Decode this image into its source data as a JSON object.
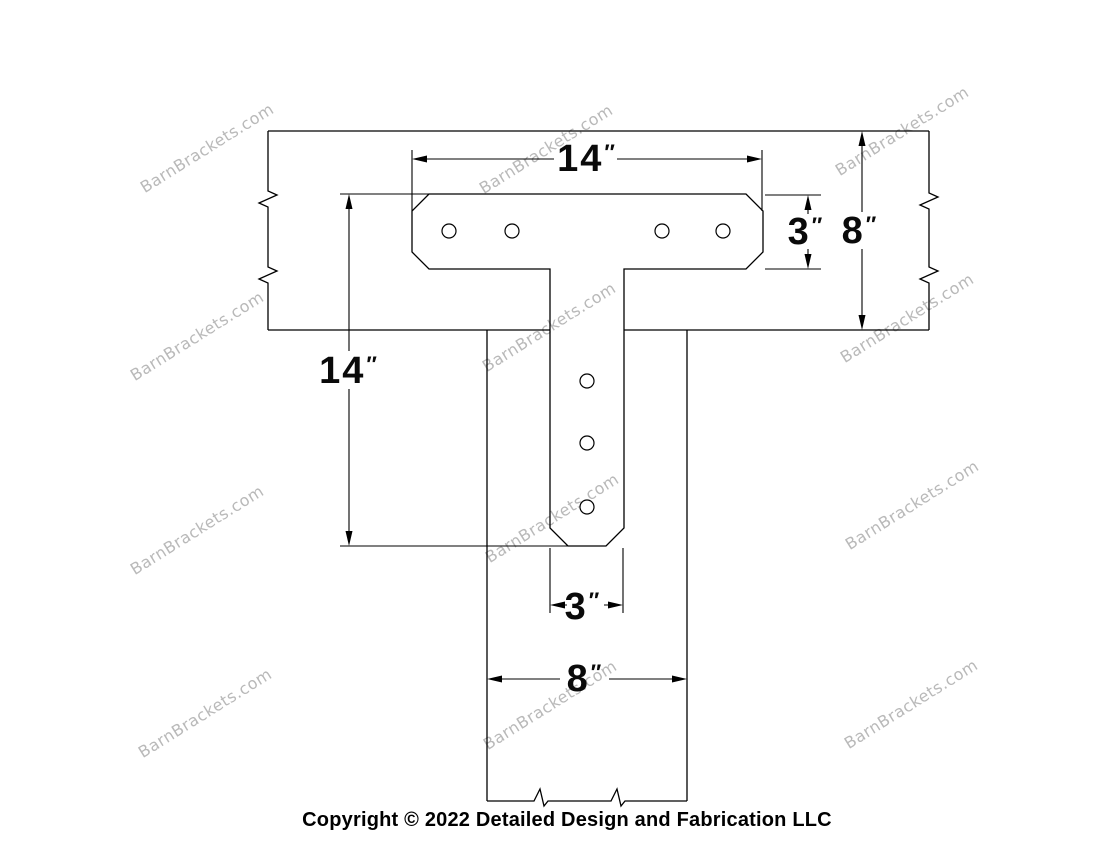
{
  "watermark": {
    "text": "BarnBrackets.com",
    "color": "#b9b9b9"
  },
  "footer": {
    "copyright_text": "Copyright © 2022 Detailed Design and Fabrication LLC"
  },
  "drawing": {
    "line_color": "#000000",
    "dimensions": {
      "bracket_width": {
        "value": "14",
        "unit": "″"
      },
      "bracket_height": {
        "value": "14",
        "unit": "″"
      },
      "top_arm_depth": {
        "value": "3",
        "unit": "″"
      },
      "horizontal_beam_depth": {
        "value": "8",
        "unit": "″"
      },
      "stem_width": {
        "value": "3",
        "unit": "″"
      },
      "vertical_beam_width": {
        "value": "8",
        "unit": "″"
      }
    }
  }
}
